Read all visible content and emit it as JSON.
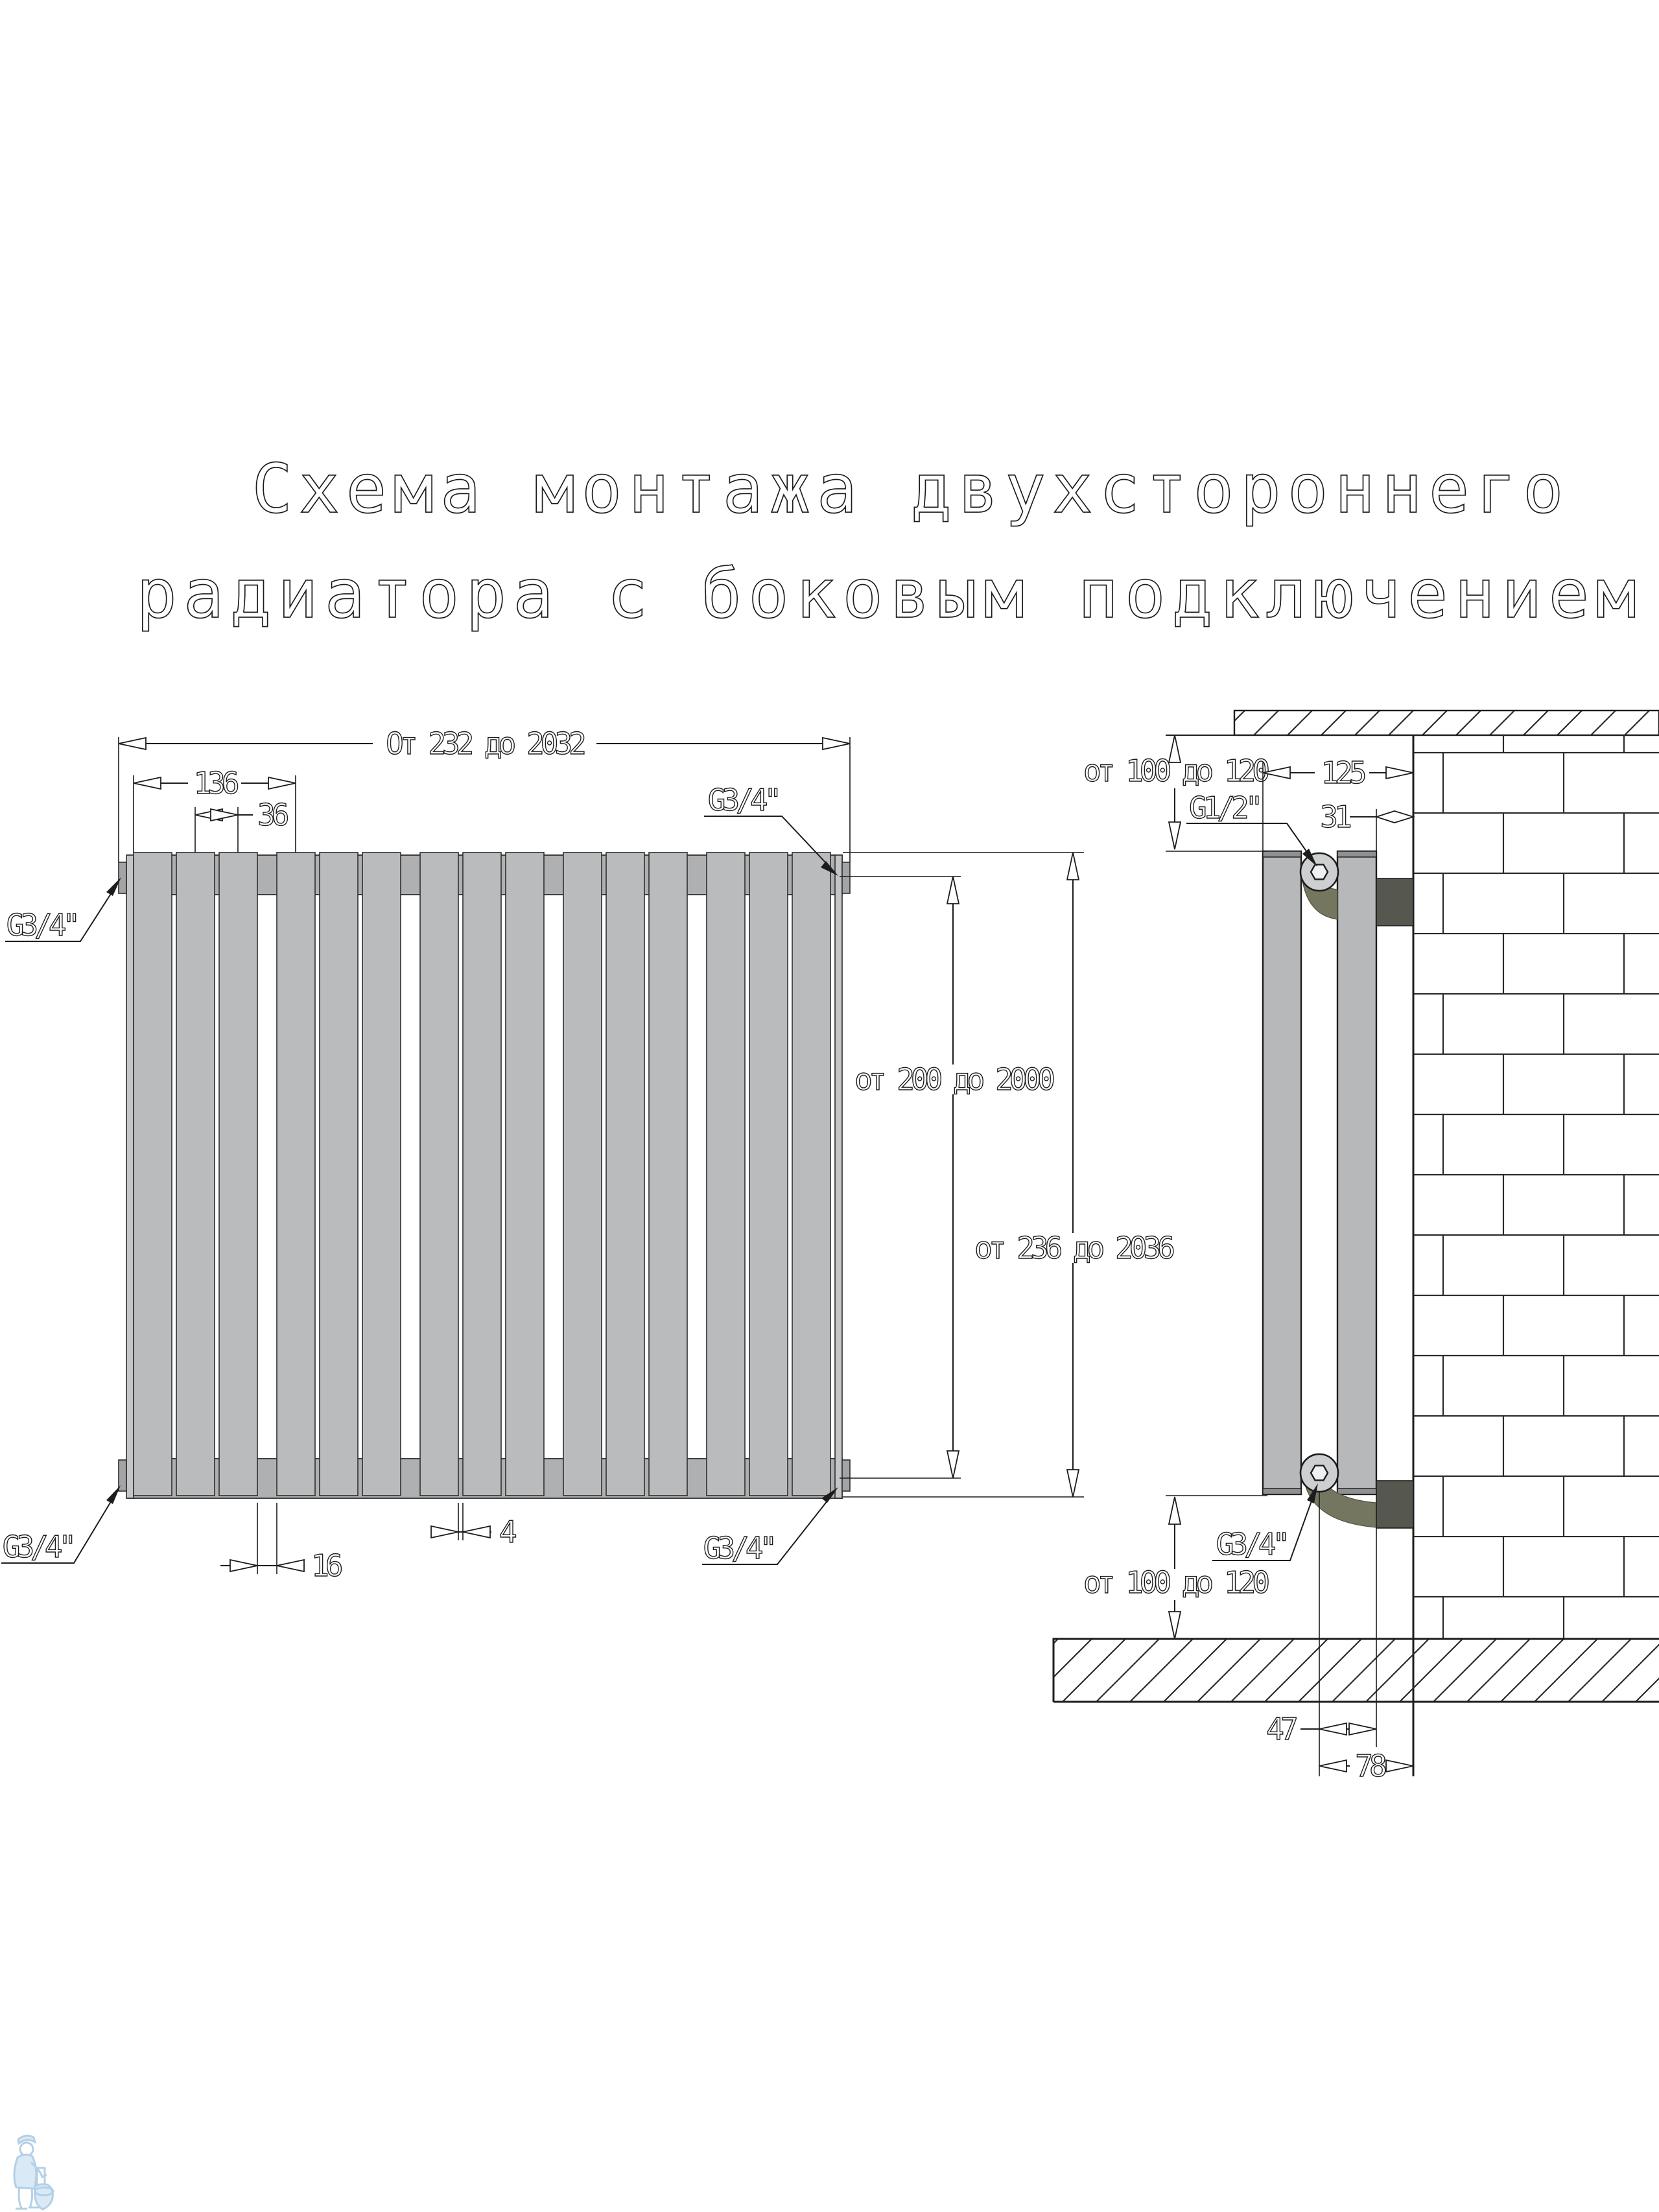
{
  "title": {
    "line1": "Схема монтажа двухстороннего",
    "line2": "радиатора с боковым подключением"
  },
  "front_view": {
    "overall_width": "От 232 до 2032",
    "mount_span": "136",
    "section_pitch": "36",
    "height_body": "от 200 до 2000",
    "height_overall": "от 236 до 2036",
    "section_gap": "4",
    "group_gap": "16",
    "conn_top_left": "G3/4\"",
    "conn_top_right": "G3/4\"",
    "conn_bottom_left": "G3/4\"",
    "conn_bottom_right": "G3/4\""
  },
  "side_view": {
    "top_clearance": "от 100 до 120",
    "wall_to_front": "125",
    "air_vent_thread": "G1/2\"",
    "wall_gap": "31",
    "bottom_thread": "G3/4\"",
    "bottom_clearance": "от 100 до 120",
    "axis_to_panel": "47",
    "axis_to_wall": "78"
  },
  "colors": {
    "line": "#1c1c1c",
    "radiator_fill": "#b9bbbd",
    "bracket_dark": "#56584f",
    "elbow_olive": "#75765f",
    "watermark_blue": "#b3d0e6"
  }
}
